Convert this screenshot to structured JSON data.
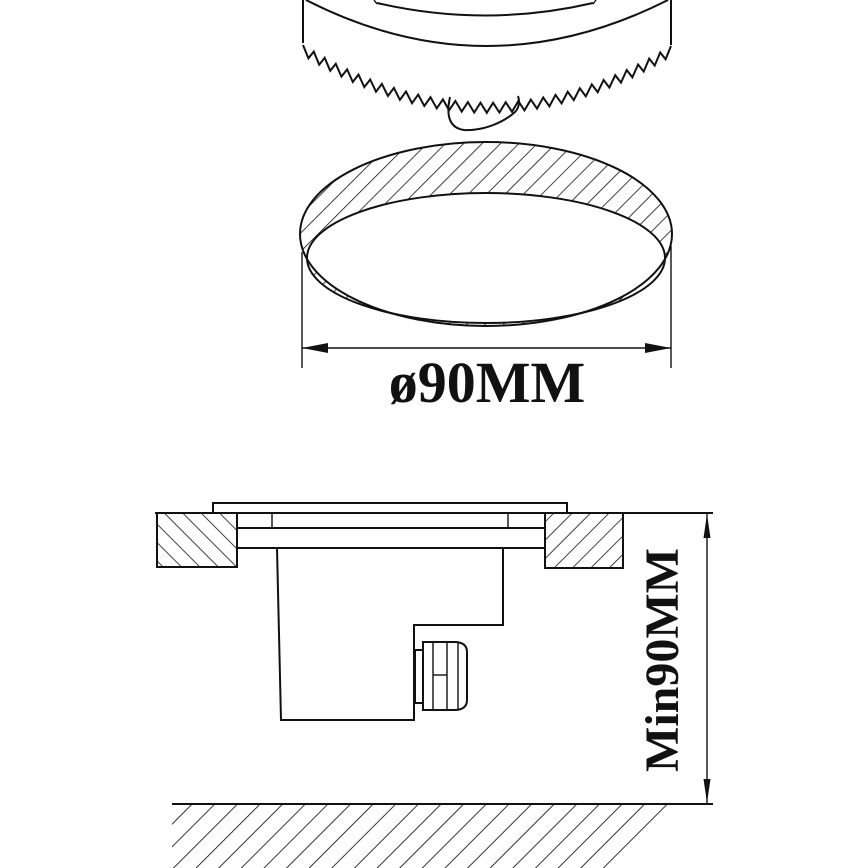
{
  "colors": {
    "line": "#111111",
    "background": "#ffffff"
  },
  "dimensions": {
    "diameter_label": "ø90MM",
    "depth_label": "Min90MM"
  }
}
